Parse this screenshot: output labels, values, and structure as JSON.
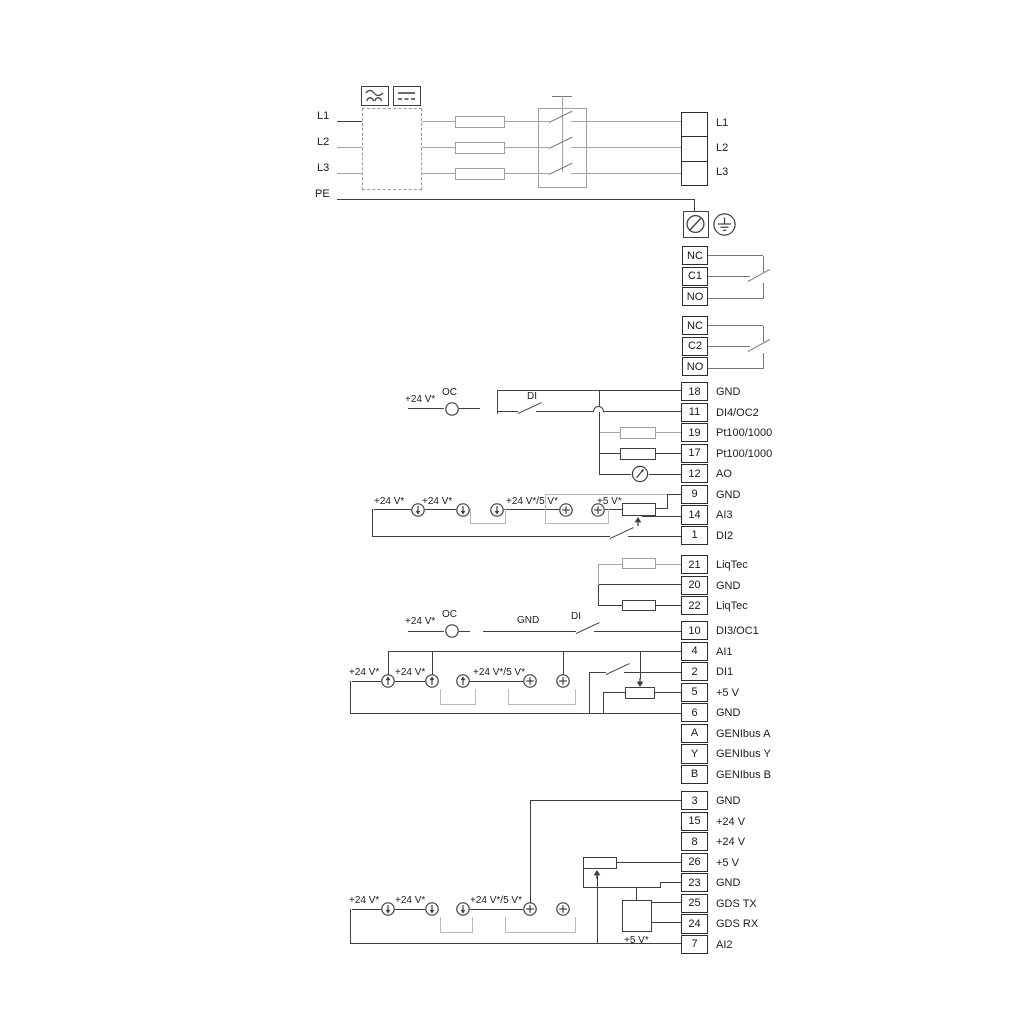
{
  "power": {
    "left_labels": [
      "L1",
      "L2",
      "L3",
      "PE"
    ],
    "right_terminals": [
      "L1",
      "L2",
      "L3"
    ],
    "converter_icons": [
      "ac-waveform",
      "dc-lines"
    ]
  },
  "relays": [
    {
      "rows": [
        "NC",
        "C1",
        "NO"
      ]
    },
    {
      "rows": [
        "NC",
        "C2",
        "NO"
      ]
    }
  ],
  "terminal_strips": {
    "io_top": [
      {
        "num": "18",
        "label": "GND"
      },
      {
        "num": "11",
        "label": "DI4/OC2"
      },
      {
        "num": "19",
        "label": "Pt100/1000"
      },
      {
        "num": "17",
        "label": "Pt100/1000"
      },
      {
        "num": "12",
        "label": "AO"
      },
      {
        "num": "9",
        "label": "GND"
      },
      {
        "num": "14",
        "label": "AI3"
      },
      {
        "num": "1",
        "label": "DI2"
      }
    ],
    "liqtec": [
      {
        "num": "21",
        "label": "LiqTec"
      },
      {
        "num": "20",
        "label": "GND"
      },
      {
        "num": "22",
        "label": "LiqTec"
      }
    ],
    "io_mid": [
      {
        "num": "10",
        "label": "DI3/OC1"
      },
      {
        "num": "4",
        "label": "AI1"
      },
      {
        "num": "2",
        "label": "DI1"
      },
      {
        "num": "5",
        "label": "+5 V"
      },
      {
        "num": "6",
        "label": "GND"
      },
      {
        "num": "A",
        "label": "GENIbus A"
      },
      {
        "num": "Y",
        "label": "GENIbus Y"
      },
      {
        "num": "B",
        "label": "GENIbus B"
      }
    ],
    "io_bottom": [
      {
        "num": "3",
        "label": "GND"
      },
      {
        "num": "15",
        "label": "+24 V"
      },
      {
        "num": "8",
        "label": "+24 V"
      },
      {
        "num": "26",
        "label": "+5 V"
      },
      {
        "num": "23",
        "label": "GND"
      },
      {
        "num": "25",
        "label": "GDS TX"
      },
      {
        "num": "24",
        "label": "GDS RX"
      },
      {
        "num": "7",
        "label": "AI2"
      }
    ]
  },
  "annotations": {
    "di4_row": {
      "v24": "+24 V*",
      "oc": "OC",
      "di": "DI"
    },
    "ai3_row": {
      "v24_a": "+24 V*",
      "v24_b": "+24 V*",
      "v24_5": "+24 V*/5 V*",
      "v5": "+5 V*"
    },
    "di3_row": {
      "v24": "+24 V*",
      "oc": "OC",
      "gnd": "GND",
      "di": "DI"
    },
    "ai1_row": {
      "v24_a": "+24 V*",
      "v24_b": "+24 V*",
      "v24_5": "+24 V*/5 V*"
    },
    "ai2_row": {
      "v24_a": "+24 V*",
      "v24_b": "+24 V*",
      "v24_5": "+24 V*/5 V*",
      "v5": "+5 V*"
    }
  },
  "colors": {
    "wire": "#3f3f3f",
    "wire_gray": "#a5a5a5",
    "wire_light": "#b9b9b9",
    "wire_medium": "#787878",
    "text": "#1c1c1c"
  }
}
